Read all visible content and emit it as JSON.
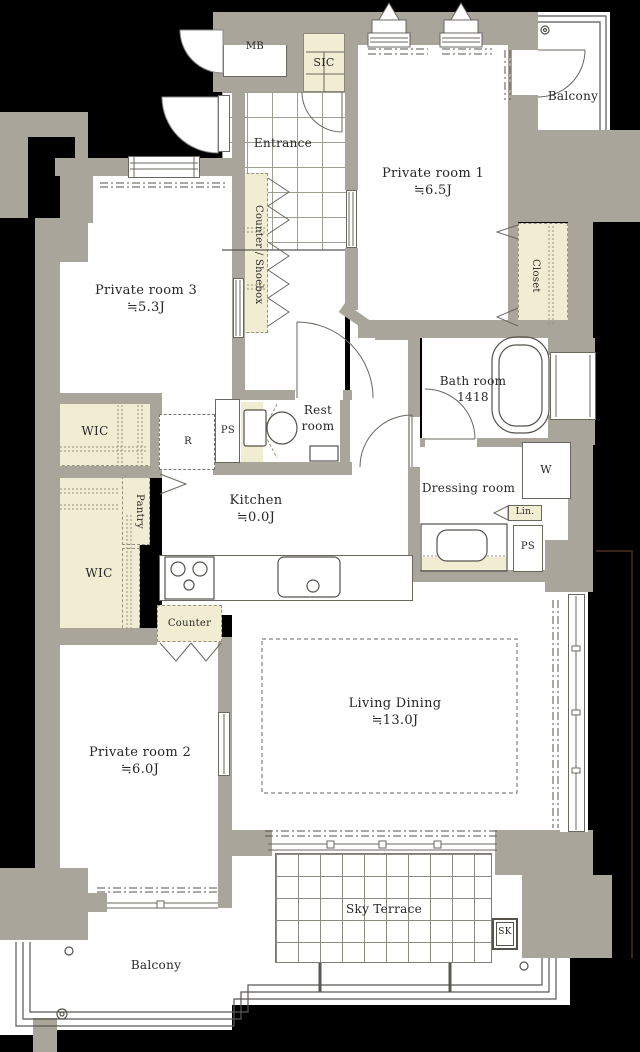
{
  "meta": {
    "kind": "apartment floor plan"
  },
  "colors": {
    "background": "#000000",
    "wall": "#a9a59b",
    "room": "#ffffff",
    "storage": "#f1edd3",
    "line": "#5a5853",
    "text": "#262626",
    "boundary_line": "#3a241a"
  },
  "rooms": {
    "mb": {
      "label": "MB"
    },
    "sic": {
      "label": "SIC"
    },
    "entrance": {
      "label": "Entrance"
    },
    "private1": {
      "label": "Private room 1",
      "size": "≒6.5J"
    },
    "balcony_top": {
      "label": "Balcony"
    },
    "private3": {
      "label": "Private room 3",
      "size": "≒5.3J"
    },
    "counter_shoebox": {
      "label": "Counter / Shoebox"
    },
    "closet": {
      "label": "Closet"
    },
    "bathroom": {
      "label": "Bath room",
      "size": "1418"
    },
    "restroom": {
      "label": "Rest room"
    },
    "wic_upper": {
      "label": "WIC"
    },
    "wic_lower": {
      "label": "WIC"
    },
    "refrigerator": {
      "label": "R"
    },
    "ps_left": {
      "label": "PS"
    },
    "ps_right": {
      "label": "PS"
    },
    "pantry": {
      "label": "Pantry"
    },
    "kitchen": {
      "label": "Kitchen",
      "size": "≒0.0J"
    },
    "dressing": {
      "label": "Dressing room"
    },
    "washer": {
      "label": "W"
    },
    "linen": {
      "label": "Lin."
    },
    "counter": {
      "label": "Counter"
    },
    "living_dining": {
      "label": "Living Dining",
      "size": "≒13.0J"
    },
    "private2": {
      "label": "Private room 2",
      "size": "≒6.0J"
    },
    "sky_terrace": {
      "label": "Sky Terrace"
    },
    "slop_sink": {
      "label": "SK"
    },
    "balcony_bottom": {
      "label": "Balcony"
    }
  }
}
